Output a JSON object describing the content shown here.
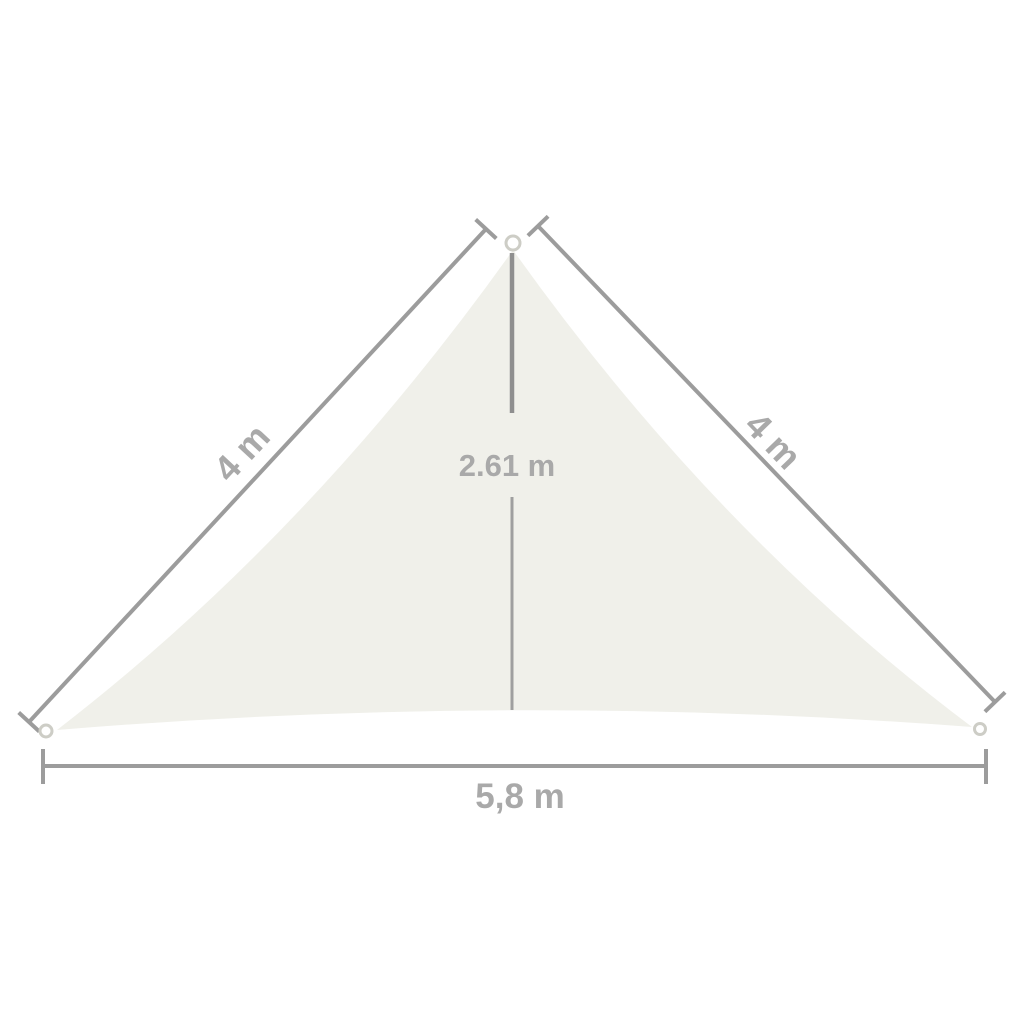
{
  "figure": {
    "type": "dimension-diagram",
    "labels": {
      "left_side": "4 m",
      "right_side": "4 m",
      "height": "2.61 m",
      "bottom_side": "5,8 m"
    },
    "colors": {
      "background": "#ffffff",
      "sail_fill": "#f0f0ea",
      "dimension_line": "#9c9c9c",
      "height_line_top": "#8f8f8f",
      "height_line_bottom": "#9f9f9f",
      "label_text": "#a9a9a9",
      "ring_stroke": "#cdcdc6"
    }
  }
}
